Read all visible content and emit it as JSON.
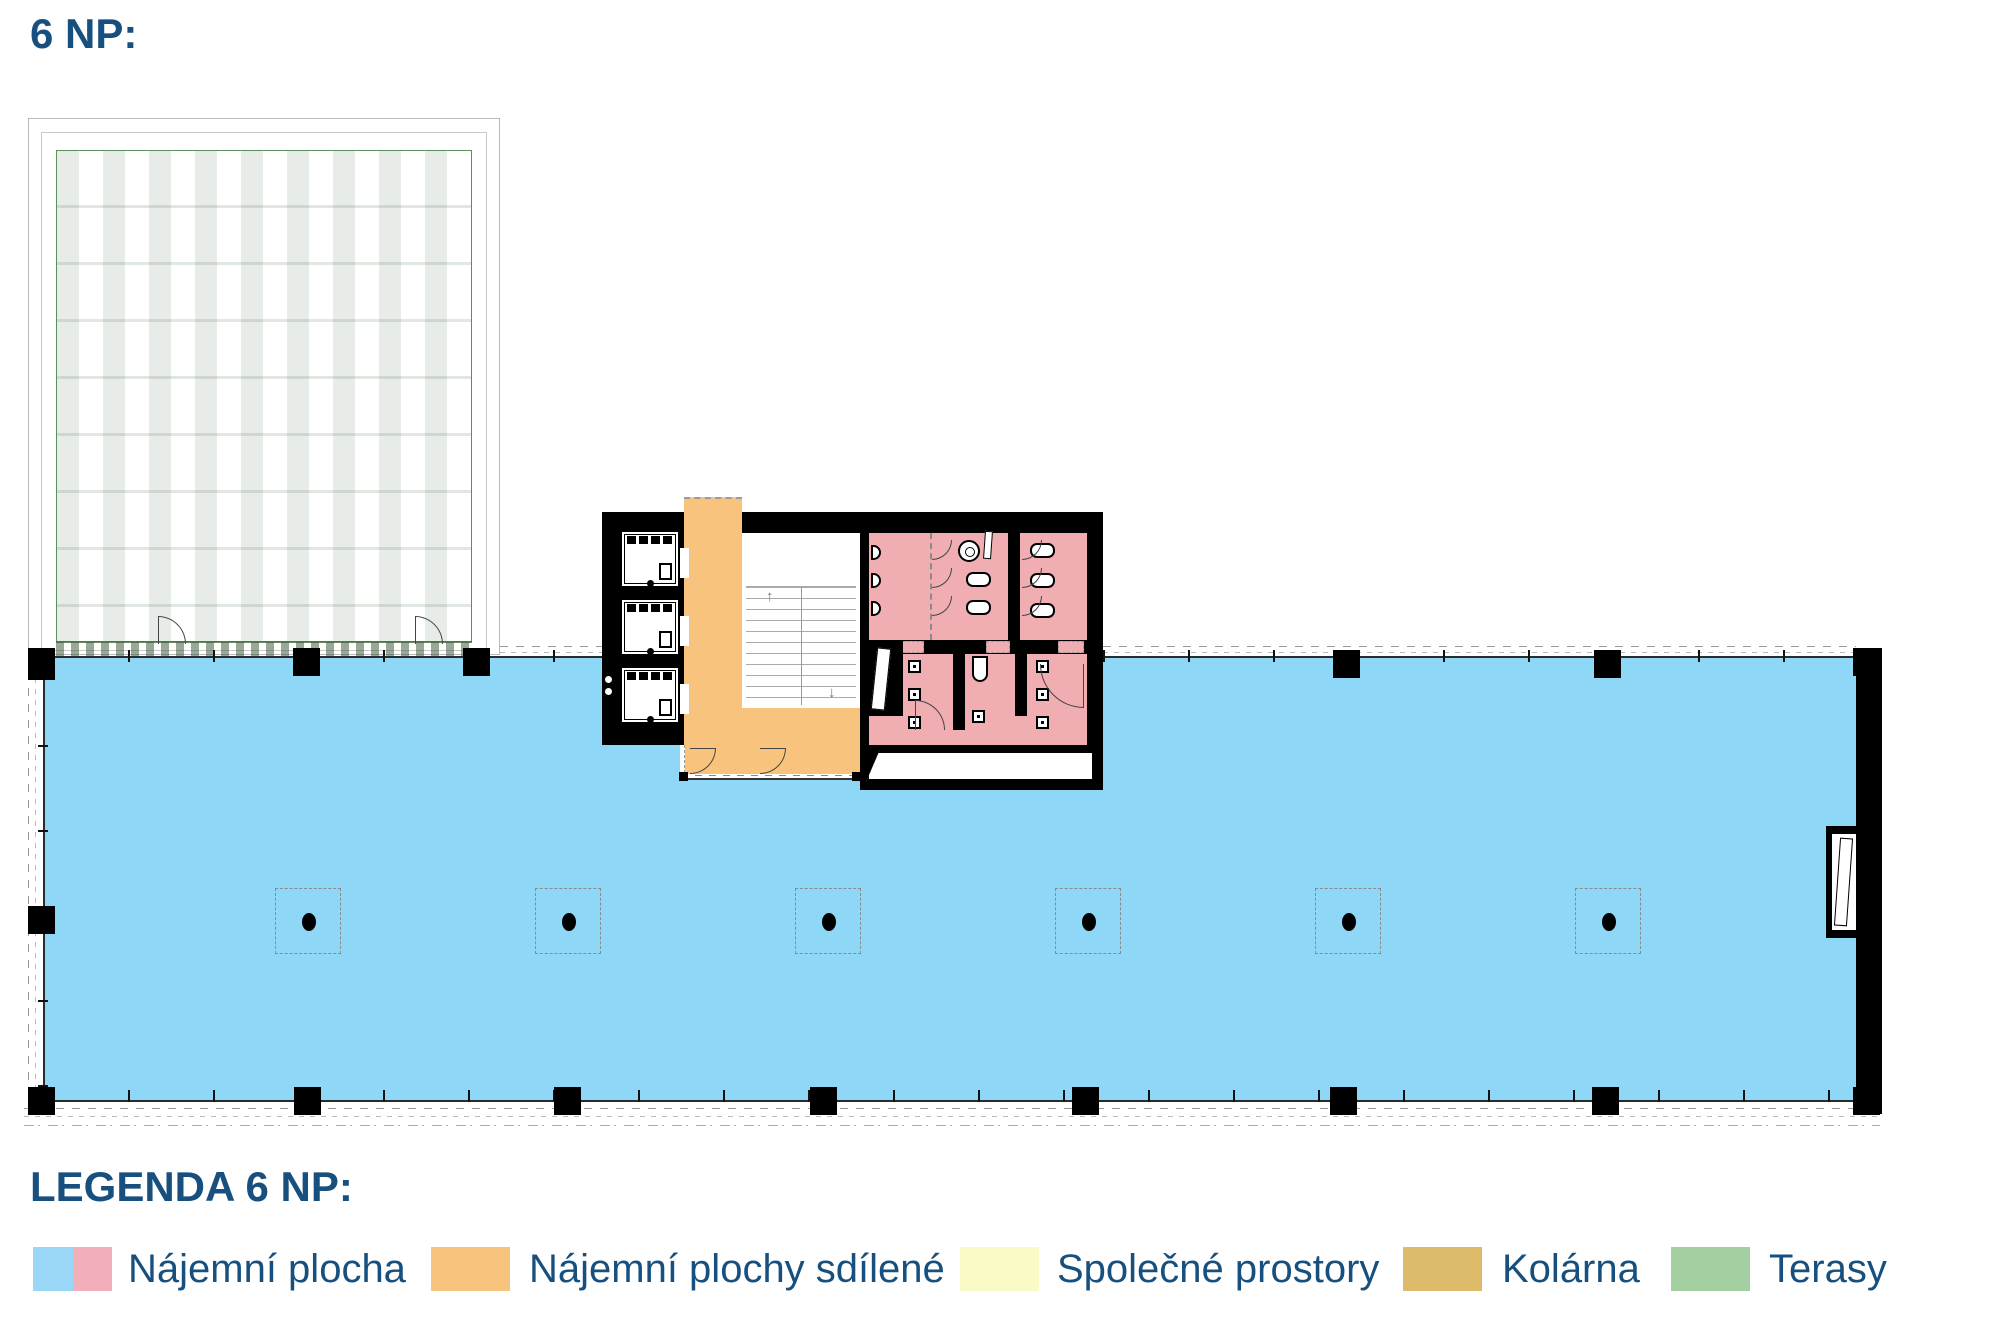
{
  "title": "6 NP:",
  "legend": {
    "heading": "LEGENDA 6 NP:",
    "items": [
      {
        "label": "Nájemní plocha",
        "swatch_colors": [
          "#9AD6F5",
          "#F2AFBA"
        ]
      },
      {
        "label": "Nájemní plochy sdílené",
        "swatch_colors": [
          "#F8C47D"
        ]
      },
      {
        "label": "Společné prostory",
        "swatch_colors": [
          "#FAFAC6"
        ]
      },
      {
        "label": "Kolárna",
        "swatch_colors": [
          "#DEBA6B"
        ]
      },
      {
        "label": "Terasy",
        "swatch_colors": [
          "#A3CFA1"
        ]
      }
    ]
  },
  "plan": {
    "floor": "6 NP",
    "area_colors": {
      "rental_blue": "#8ED7F7",
      "rental_pink": "#F1AEB2",
      "shared_orange": "#F8C47D",
      "terrace_green": "#A3CFA1"
    },
    "stairs": {
      "arrow_up": "↑",
      "arrow_down": "↓"
    }
  },
  "text_color": "#17507E"
}
